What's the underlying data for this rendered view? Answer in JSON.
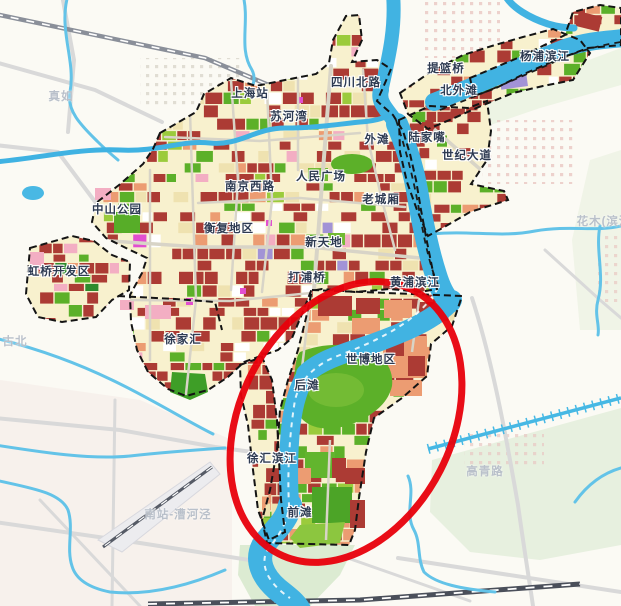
{
  "map": {
    "description": "Shanghai central-city land-use planning map with Expo riverside area circled in red",
    "highlight": {
      "shape": "ellipse",
      "color": "#E8000B"
    },
    "colors": {
      "background": "#FBFAF4",
      "water": "#41B3E2",
      "water_light": "#63C3E8",
      "city_base_cream": "#F8F1CE",
      "parcel_red": "#AC3B34",
      "parcel_salmon": "#EC9C72",
      "park_green": "#5CB029",
      "light_green": "#9BCB3C",
      "dark_green": "#2E8B2E",
      "pink": "#F3AEC3",
      "magenta": "#E24FD0",
      "purple": "#A293D6",
      "tan": "#EFE2B0",
      "white_parcel": "#FFFFFF",
      "road_in_city": "#D8D4C7",
      "road_background": "#D9D9D9",
      "rail_dark": "#4A4F5A",
      "rail_light": "#8A8F99",
      "boundary_dash": "#141414",
      "label_major": "#2E3B52",
      "label_faint": "#B9C0CA",
      "bg_green_area": "#E7F0DF",
      "bg_pink_tint": "#F6EEE9"
    },
    "labels": {
      "major": [
        {
          "text": "上海站",
          "x": 250,
          "y": 93
        },
        {
          "text": "四川北路",
          "x": 356,
          "y": 82
        },
        {
          "text": "提篮桥",
          "x": 446,
          "y": 68
        },
        {
          "text": "北外滩",
          "x": 459,
          "y": 90
        },
        {
          "text": "杨浦滨江",
          "x": 545,
          "y": 56
        },
        {
          "text": "苏河湾",
          "x": 289,
          "y": 116
        },
        {
          "text": "外滩",
          "x": 377,
          "y": 139
        },
        {
          "text": "陆家嘴",
          "x": 427,
          "y": 137
        },
        {
          "text": "世纪大道",
          "x": 467,
          "y": 155
        },
        {
          "text": "南京西路",
          "x": 250,
          "y": 186
        },
        {
          "text": "人民广场",
          "x": 321,
          "y": 176
        },
        {
          "text": "老城厢",
          "x": 381,
          "y": 199
        },
        {
          "text": "中山公园",
          "x": 117,
          "y": 209
        },
        {
          "text": "衡复地区",
          "x": 229,
          "y": 228
        },
        {
          "text": "新天地",
          "x": 324,
          "y": 242
        },
        {
          "text": "虹桥开发区",
          "x": 59,
          "y": 271
        },
        {
          "text": "打浦桥",
          "x": 307,
          "y": 277
        },
        {
          "text": "黄浦滨江",
          "x": 415,
          "y": 282
        },
        {
          "text": "徐家汇",
          "x": 183,
          "y": 339
        },
        {
          "text": "世博地区",
          "x": 371,
          "y": 359
        },
        {
          "text": "后滩",
          "x": 307,
          "y": 385
        },
        {
          "text": "徐汇滨江",
          "x": 272,
          "y": 458
        },
        {
          "text": "前滩",
          "x": 300,
          "y": 512
        }
      ],
      "faint": [
        {
          "text": "真如",
          "x": 61,
          "y": 96
        },
        {
          "text": "古北",
          "x": 15,
          "y": 341
        },
        {
          "text": "南站-漕河泾",
          "x": 178,
          "y": 514
        },
        {
          "text": "高青路",
          "x": 485,
          "y": 471
        },
        {
          "text": "花木(滨河",
          "x": 604,
          "y": 221
        }
      ]
    }
  }
}
